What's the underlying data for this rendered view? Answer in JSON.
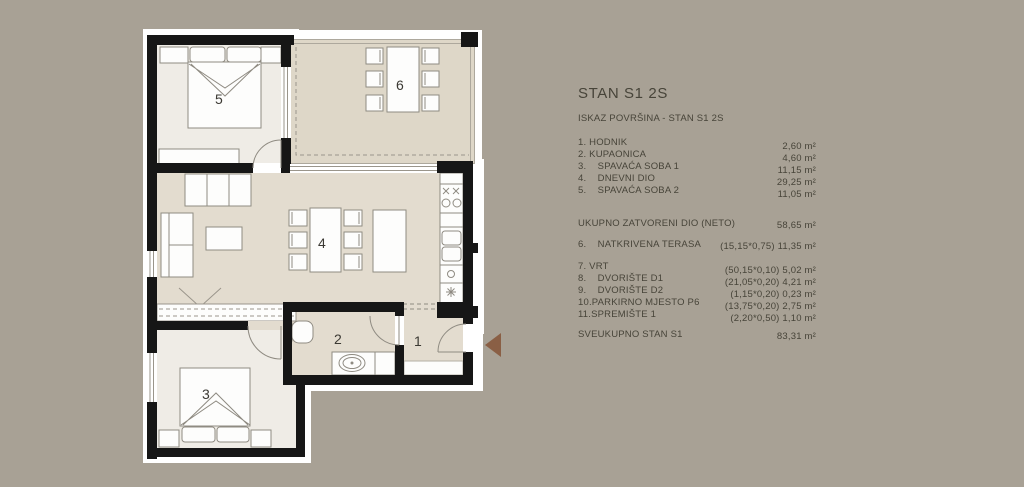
{
  "panel": {
    "title": "STAN S1 2S",
    "subtitle": "ISKAZ POVRŠINA - STAN S1 2S",
    "closed_rooms": [
      {
        "label": "1. HODNIK",
        "value": "2,60 m²"
      },
      {
        "label": "2. KUPAONICA",
        "value": "4,60 m²"
      },
      {
        "label": "3.    SPAVAĆA SOBA 1",
        "value": "11,15 m²"
      },
      {
        "label": "4.    DNEVNI DIO",
        "value": "29,25 m²"
      },
      {
        "label": "5.    SPAVAĆA SOBA 2",
        "value": "11,05 m²"
      }
    ],
    "total_closed": {
      "label": "UKUPNO ZATVORENI DIO (NETO)",
      "value": "58,65 m²"
    },
    "terrace_row": {
      "label": "6.    NATKRIVENA TERASA",
      "value": "(15,15*0,75) 11,35 m²"
    },
    "outdoor_rows": [
      {
        "label": "7. VRT",
        "value": "(50,15*0,10) 5,02 m²"
      },
      {
        "label": "8.    DVORIŠTE D1",
        "value": "(21,05*0,20) 4,21 m²"
      },
      {
        "label": "9.    DVORIŠTE D2",
        "value": "(1,15*0,20) 0,23 m²"
      },
      {
        "label": "10.PARKIRNO MJESTO P6",
        "value": "(13,75*0,20) 2,75 m²"
      },
      {
        "label": "11.SPREMIŠTE 1",
        "value": "(2,20*0,50) 1,10 m²"
      }
    ],
    "grand_total": {
      "label": "SVEUKUPNO STAN S1",
      "value": "83,31 m²"
    }
  },
  "plan": {
    "rooms": {
      "r1": "1",
      "r2": "2",
      "r3": "3",
      "r4": "4",
      "r5": "5",
      "r6": "6"
    }
  },
  "colors": {
    "background": "#a8a195",
    "wall": "#161616",
    "floor_light": "#efece6",
    "floor_tan": "#e3dccf",
    "floor_terrace": "#ded7c8",
    "entrance_arrow": "#8a5f45",
    "text": "#474439"
  }
}
